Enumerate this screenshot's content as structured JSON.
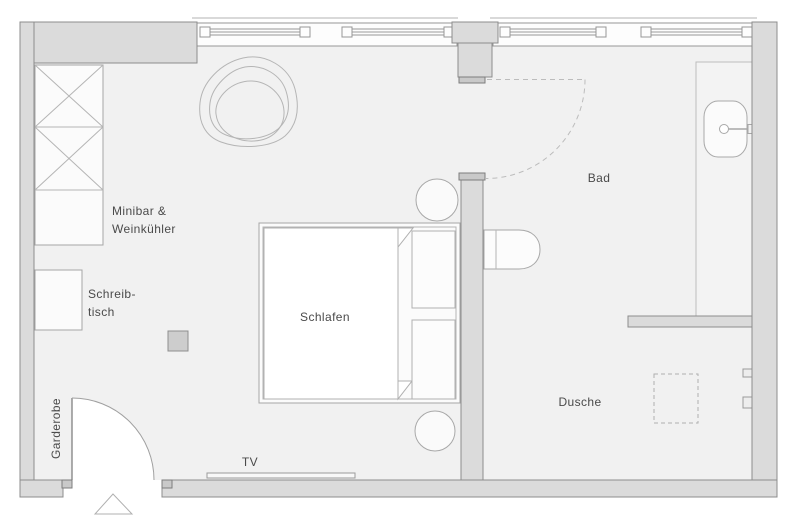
{
  "plan": {
    "title": "hotel room floor plan",
    "rooms": {
      "sleeping": {
        "label": "Schlafen"
      },
      "bathroom": {
        "label": "Bad"
      },
      "shower": {
        "label": "Dusche"
      }
    },
    "furniture": {
      "minibar_line1": "Minibar &",
      "minibar_line2": "Weinkühler",
      "desk_line1": "Schreib-",
      "desk_line2": "tisch",
      "wardrobe": "Garderobe",
      "tv": "TV"
    },
    "colors": {
      "background": "#ffffff",
      "room_fill": "#f1f1f1",
      "wall_fill": "#dbdbdb",
      "wall_stroke": "#8d8d8d",
      "furniture_stroke": "#a6a6a6",
      "label_text": "#4a4a4a"
    }
  }
}
